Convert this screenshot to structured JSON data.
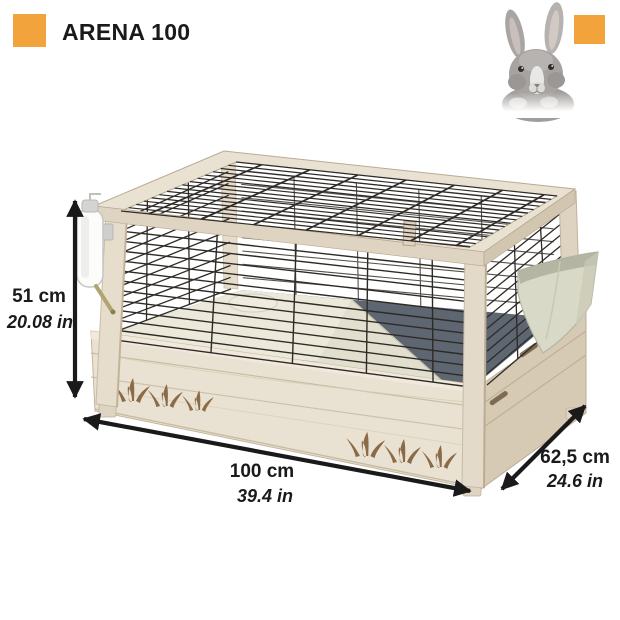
{
  "header": {
    "title": "ARENA 100"
  },
  "dimensions": {
    "height": {
      "cm": "51 cm",
      "inches": "20.08 in"
    },
    "width": {
      "cm": "100 cm",
      "inches": "39.4 in"
    },
    "depth": {
      "cm": "62,5 cm",
      "inches": "24.6 in"
    }
  },
  "colors": {
    "accent": "#F2A33C",
    "text": "#1A1A1A",
    "wood_light": "#E9E1D2",
    "wood_mid": "#DFD4C2",
    "wood_dark": "#D6CAB5",
    "wire": "#2E2B27",
    "wire_back": "#55514A",
    "interior_floor": "#5E6672",
    "platform": "#ECE9DA",
    "ramp": "#E2DFCE",
    "feeder": "#D9D9C8",
    "carving": "#8B6B47",
    "rabbit_gray": "#A6A3A1"
  },
  "icons": {
    "brand_square": "orange-square",
    "corner_square": "orange-square",
    "rabbit": "gray-rabbit-photo"
  }
}
